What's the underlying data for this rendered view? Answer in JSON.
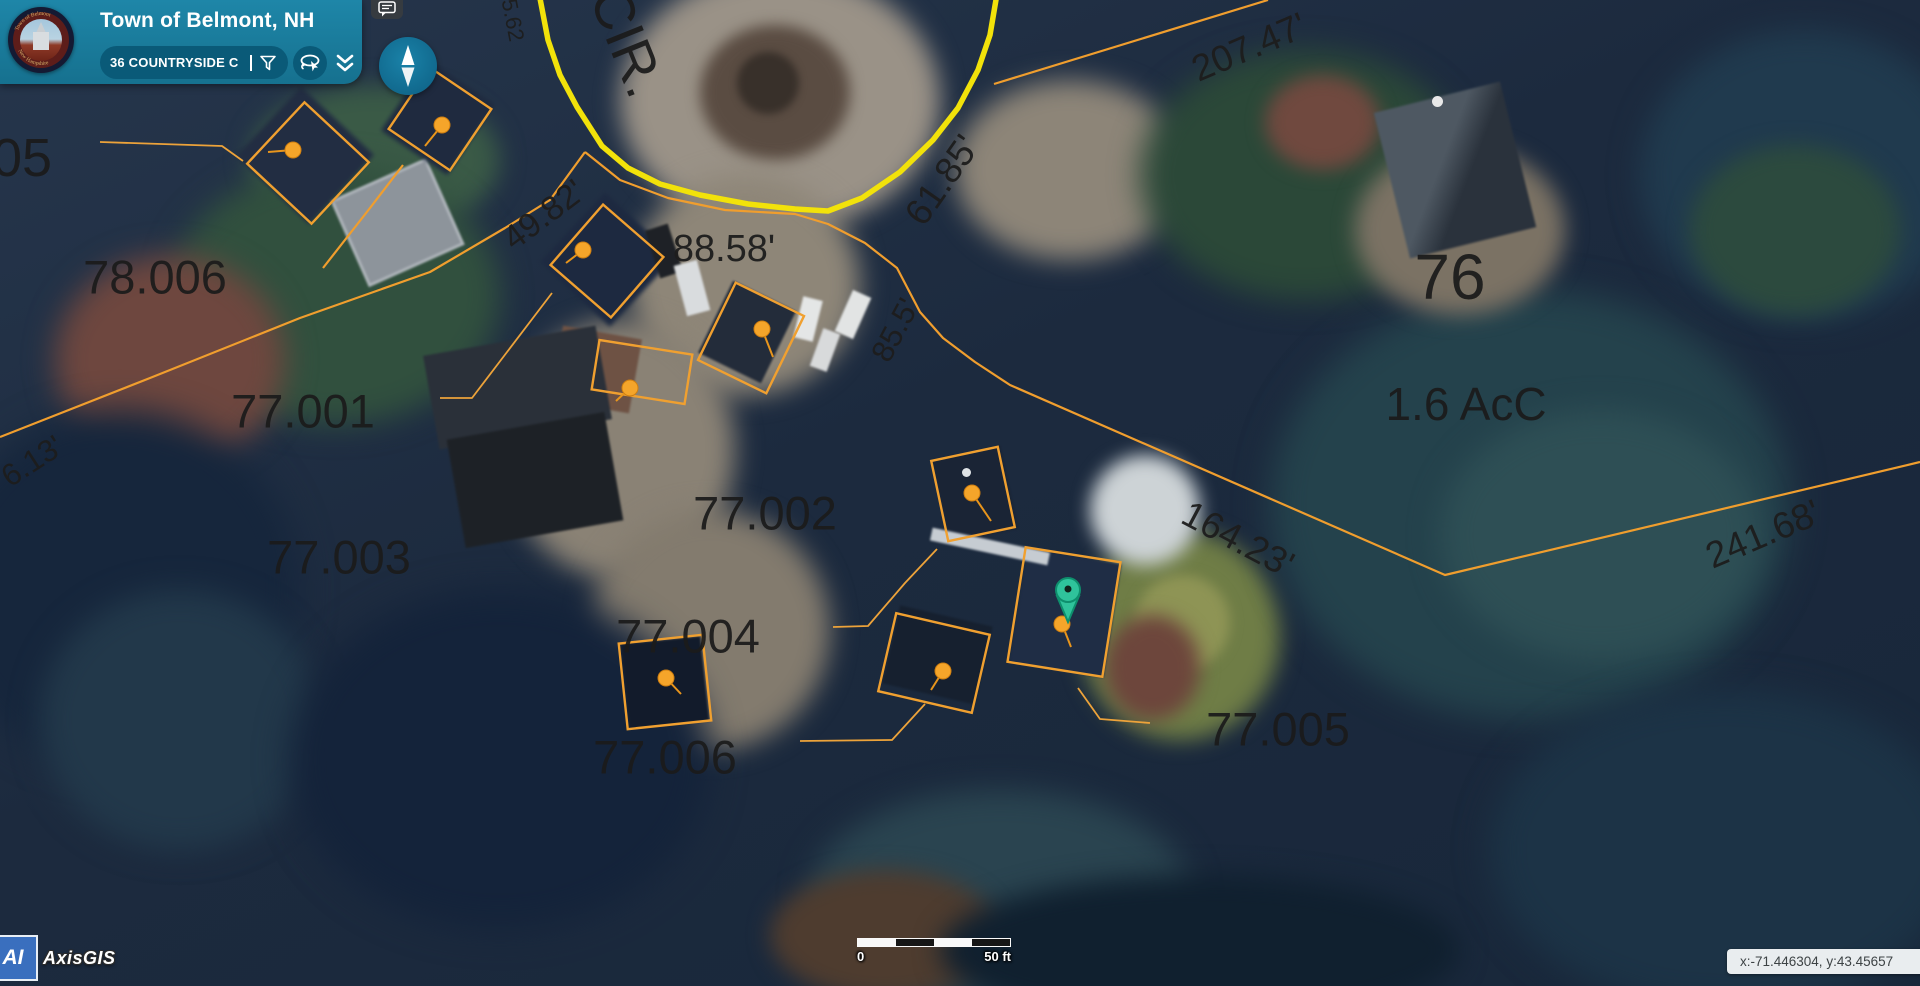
{
  "header": {
    "title": "Town of Belmont, NH",
    "search_value": "36 COUNTRYSIDE C",
    "logo_ring_top": "Town of Belmont",
    "logo_ring_bottom": "New Hampshire",
    "icons": {
      "filter": "funnel",
      "draw_select": "lasso-pointer",
      "collapse": "chevron-double-down",
      "comments": "speech-bubble",
      "compass": "north-arrow"
    }
  },
  "map": {
    "road_label": "CIR.",
    "parcels": [
      "05",
      "78.006",
      "77.001",
      "77.002",
      "77.003",
      "77.004",
      "77.005",
      "77.006",
      "76"
    ],
    "area_label": "1.6 AcC",
    "dimensions": [
      "207.47'",
      "61.85'",
      "85.5'",
      "88.58'",
      "49.82'",
      "164.23'",
      "241.68'",
      "6.13'",
      "5.62"
    ],
    "colors": {
      "parcel_line": "#f09e2e",
      "road_outline": "#f2e20a",
      "building_marker": "#f5a52a",
      "selected_pin": "#2fc39b",
      "label": "#1b1b1b"
    }
  },
  "scalebar": {
    "min": "0",
    "max": "50 ft"
  },
  "statusbar": {
    "coordinates": "x:-71.446304, y:43.45657"
  },
  "watermark": {
    "badge": "AI",
    "brand": "AxisGIS"
  }
}
